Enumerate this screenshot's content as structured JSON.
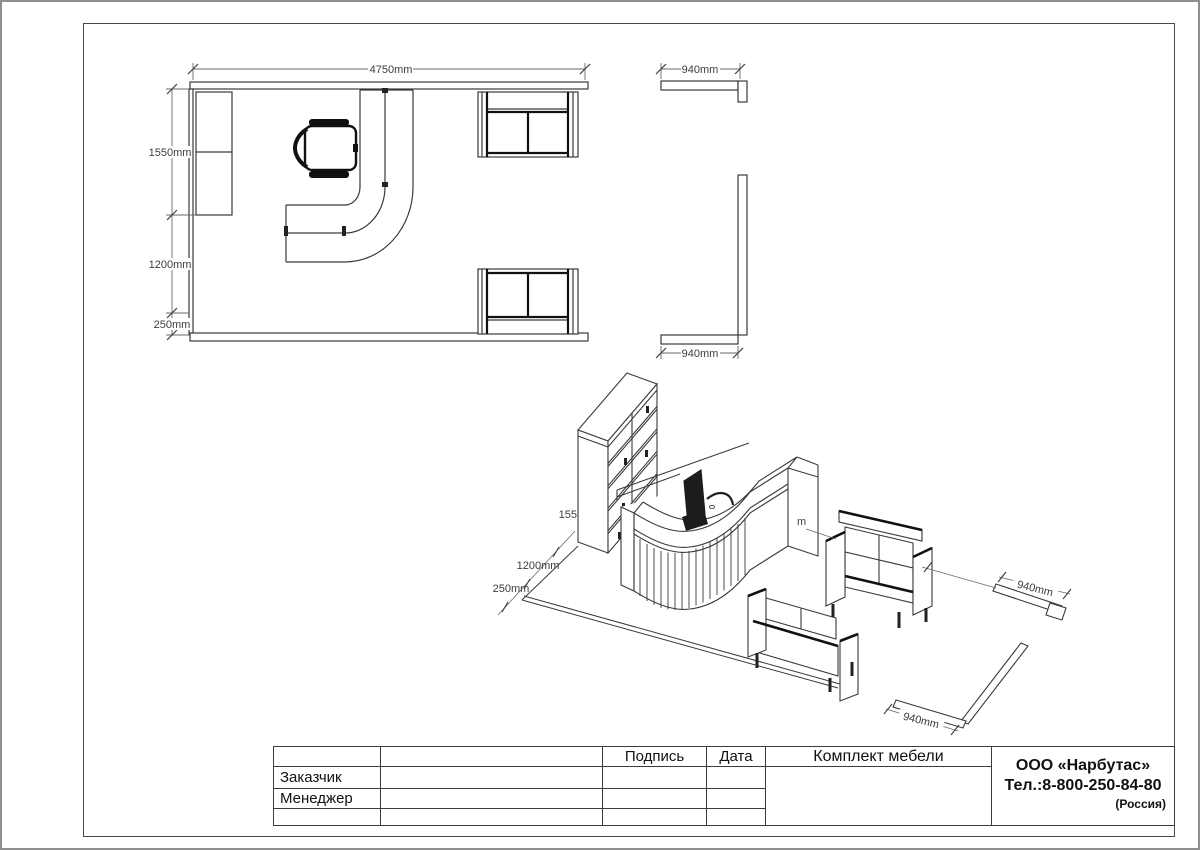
{
  "plan": {
    "width_label": "4750mm",
    "height_labels": [
      "1550mm",
      "1200mm",
      "250mm"
    ],
    "wall_top_label": "940mm",
    "wall_bottom_label": "940mm"
  },
  "iso": {
    "height_label_partial": "155",
    "depth_label": "1200mm",
    "edge_label": "250mm",
    "wall_upper_label": "940mm",
    "wall_lower_label": "940mm",
    "hidden_label_fragment": "m"
  },
  "title_block": {
    "col_signature": "Подпись",
    "col_date": "Дата",
    "row_customer": "Заказчик",
    "row_manager": "Менеджер",
    "project_title": "Комплект мебели",
    "company": {
      "name": "ООО «Нарбутас»",
      "phone": "Тел.:8-800-250-84-80",
      "country": "(Россия)"
    }
  },
  "colors": {
    "line": "#3a3a3a",
    "dark": "#151515",
    "dim_line": "#6a6a6a",
    "dim_text": "#3d3d3d",
    "frame": "#4a4a4a"
  }
}
